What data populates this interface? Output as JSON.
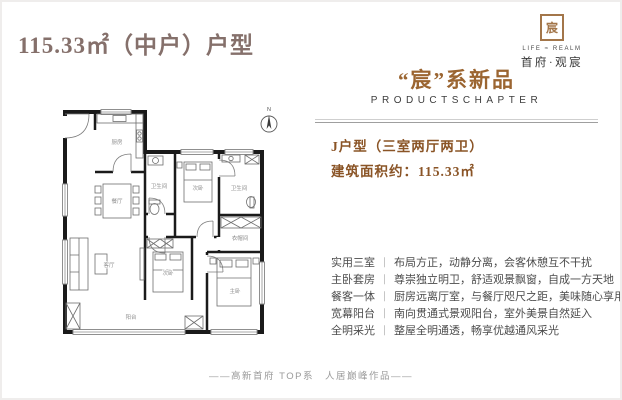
{
  "page": {
    "title": "115.33㎡（中户）户型",
    "footer": "——高新首府 TOP系　人居巅峰作品——"
  },
  "logo": {
    "icon_glyph": "宸",
    "name_en": "LIFE ≈ REALM",
    "name_cn": "首府·观宸"
  },
  "right_panel": {
    "series_title": "“宸”系新品",
    "series_subtitle": "PRODUCTSCHAPTER",
    "unit_type": "J户型（三室两厅两卫）",
    "area_label": "建筑面积约：115.33㎡",
    "separator": "｜",
    "features": [
      {
        "label": "实用三室",
        "text": "布局方正，动静分离，会客休憩互不干扰"
      },
      {
        "label": "主卧套房",
        "text": "尊崇独立明卫，舒适观景飘窗，自成一方天地"
      },
      {
        "label": "餐客一体",
        "text": "厨房远离厅室，与餐厅咫尺之距，美味随心享用"
      },
      {
        "label": "宽幕阳台",
        "text": "南向贯通式景观阳台，室外美景自然延入"
      },
      {
        "label": "全明采光",
        "text": "整屋全明通透，畅享优越通风采光"
      }
    ]
  },
  "floor_plan": {
    "compass_label": "N",
    "rooms": [
      "厨房",
      "餐厅",
      "卫生间",
      "次卧",
      "卫生间",
      "衣帽间",
      "客厅",
      "次卧",
      "主卧",
      "阳台"
    ]
  },
  "colors": {
    "title_taupe": "#85706b",
    "accent_bronze": "#9b6531",
    "deep_brown": "#8a5426",
    "text_dark": "#4c4c4c",
    "footer_gray": "#9a9a9a"
  }
}
